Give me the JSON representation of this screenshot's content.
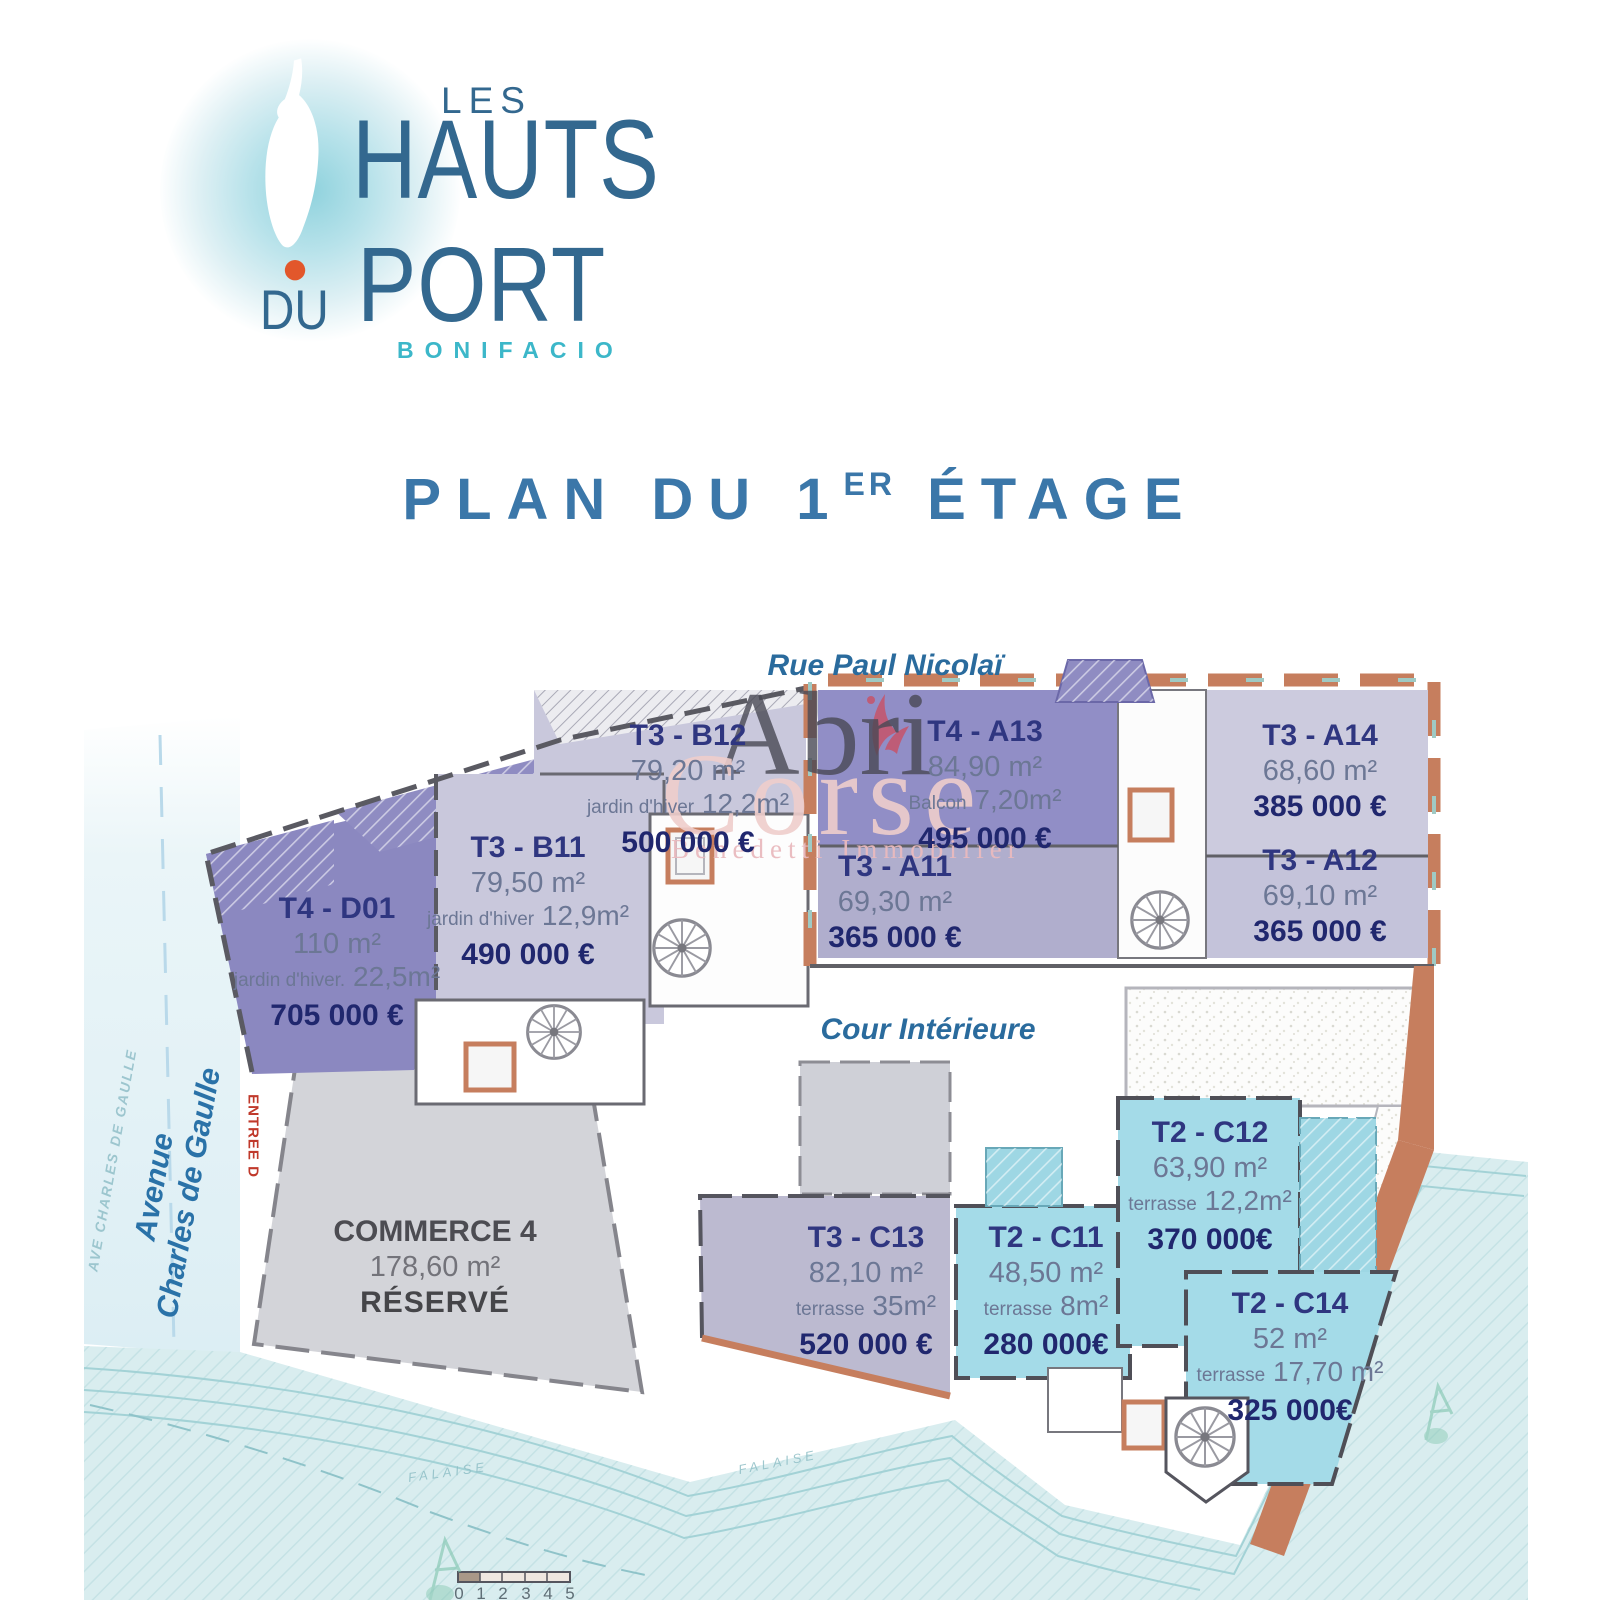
{
  "logo": {
    "les": "LES",
    "hauts": "HAUTS",
    "du": "DU",
    "port": "PORT",
    "city": "BONIFACIO"
  },
  "title": {
    "prefix": "PLAN DU 1",
    "sup": "ER",
    "suffix": " ÉTAGE"
  },
  "labels": {
    "street_top": "Rue Paul Nicolaï",
    "courtyard": "Cour Intérieure",
    "street_left_line1": "Avenue",
    "street_left_line2": "Charles de Gaulle",
    "street_left_faint": "AVE CHARLES DE GAULLE",
    "entrance_d": "ENTREE D",
    "falaise": "FALAISE"
  },
  "watermark": {
    "line1": "Abri",
    "line2": "Corse",
    "line3": "Benedetti Immobilier"
  },
  "units": [
    {
      "code": "T3 - B12",
      "area": "79,20 m²",
      "extra_label": "jardin d'hiver",
      "extra_value": "12,2m²",
      "price": "500 000 €"
    },
    {
      "code": "T4 - A13",
      "area": "84,90 m²",
      "extra_label": "Balcon",
      "extra_value": "7,20m²",
      "price": "495 000 €"
    },
    {
      "code": "T3 - A14",
      "area": "68,60 m²",
      "price": "385 000 €"
    },
    {
      "code": "T3 - B11",
      "area": "79,50 m²",
      "extra_label": "jardin d'hiver",
      "extra_value": "12,9m²",
      "price": "490 000 €"
    },
    {
      "code": "T3 - A11",
      "area": "69,30 m²",
      "price": "365 000 €"
    },
    {
      "code": "T3 - A12",
      "area": "69,10 m²",
      "price": "365 000 €"
    },
    {
      "code": "T4 - D01",
      "area": "110 m²",
      "extra_label": "jardin d'hiver.",
      "extra_value": "22,5m²",
      "price": "705 000 €"
    },
    {
      "code": "COMMERCE 4",
      "area": "178,60 m²",
      "status": "RÉSERVÉ"
    },
    {
      "code": "T3 - C13",
      "area": "82,10 m²",
      "extra_label": "terrasse",
      "extra_value": "35m²",
      "price": "520 000 €"
    },
    {
      "code": "T2 - C11",
      "area": "48,50 m²",
      "extra_label": "terrasse",
      "extra_value": "8m²",
      "price": "280 000€"
    },
    {
      "code": "T2 - C12",
      "area": "63,90 m²",
      "extra_label": "terrasse",
      "extra_value": "12,2m²",
      "price": "370 000€"
    },
    {
      "code": "T2 - C14",
      "area": "52 m²",
      "extra_label": "terrasse",
      "extra_value": "17,70 m²",
      "price": "325 000€"
    }
  ],
  "scale": {
    "ticks": [
      "0",
      "1",
      "2",
      "3",
      "4",
      "5"
    ]
  },
  "colors": {
    "title_blue": "#3b77a9",
    "street_blue": "#2a6b9d",
    "logo_blue": "#33688f",
    "logo_teal": "#3cb7c9",
    "orange_dot": "#e2572b",
    "salmon_facade": "#c67e5e",
    "purple_unit": "#8f8cc2",
    "lavender_unit": "#c9c8dc",
    "cyan_unit": "#a4dbe8",
    "terrain": "#d9edef",
    "navy_code": "#2f3680",
    "navy_price": "#20276e",
    "entrance_red": "#c0392b"
  }
}
